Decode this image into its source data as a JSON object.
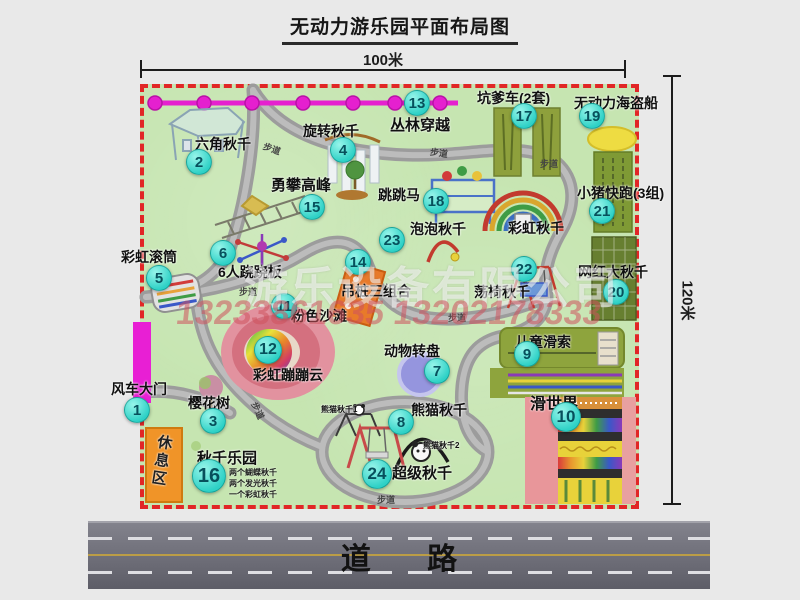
{
  "title": "无动力游乐园平面布局图",
  "dimensions": {
    "top": "100米",
    "right": "120米"
  },
  "watermark": {
    "company": "游乐设备有限公司",
    "phone": "13233861635 13202178333"
  },
  "road": {
    "label": "道 路"
  },
  "map": {
    "trail_label": "步道",
    "trail_labels": [
      [
        263,
        142,
        20
      ],
      [
        430,
        146,
        8
      ],
      [
        540,
        157,
        0
      ],
      [
        239,
        285,
        0
      ],
      [
        448,
        311,
        0
      ],
      [
        249,
        404,
        65
      ],
      [
        377,
        493,
        0
      ]
    ],
    "items": [
      {
        "num": 1,
        "label": "风车大门",
        "label_pos": [
          111,
          382
        ],
        "marker": [
          137,
          410
        ]
      },
      {
        "num": 2,
        "label": "六角秋千",
        "label_pos": [
          195,
          137
        ],
        "marker": [
          199,
          162
        ]
      },
      {
        "num": 3,
        "label": "樱花树",
        "label_pos": [
          188,
          396
        ],
        "marker": [
          213,
          421
        ]
      },
      {
        "num": 4,
        "label": "旋转秋千",
        "label_pos": [
          303,
          124
        ],
        "marker": [
          343,
          150
        ]
      },
      {
        "num": 5,
        "label": "彩虹滚筒",
        "label_pos": [
          121,
          250
        ],
        "marker": [
          159,
          278
        ]
      },
      {
        "num": 6,
        "label": "6人跷跷板",
        "label_pos": [
          218,
          265
        ],
        "marker": [
          223,
          253
        ]
      },
      {
        "num": 7,
        "label": "动物转盘",
        "label_pos": [
          384,
          344
        ],
        "marker": [
          437,
          371
        ]
      },
      {
        "num": 8,
        "label": "熊猫秋千",
        "label_pos": [
          411,
          403
        ],
        "marker": [
          401,
          422
        ]
      },
      {
        "num": 9,
        "label": "儿童滑索",
        "label_pos": [
          515,
          335
        ],
        "marker": [
          527,
          354
        ]
      },
      {
        "num": 10,
        "label": "滑世界",
        "label_pos": [
          530,
          396
        ],
        "marker": [
          566,
          417
        ],
        "label_size": 16,
        "marker_size": 30
      },
      {
        "num": 11,
        "label": "粉色沙滩",
        "label_pos": [
          291,
          309
        ],
        "marker": [
          284,
          306
        ]
      },
      {
        "num": 12,
        "label": "彩虹蹦蹦云",
        "label_pos": [
          253,
          368
        ],
        "marker": [
          268,
          350
        ],
        "marker_size": 28
      },
      {
        "num": 13,
        "label": "丛林穿越",
        "label_pos": [
          390,
          118
        ],
        "marker": [
          417,
          103
        ],
        "label_size": 15
      },
      {
        "num": 14,
        "label": "吊桩三组合",
        "label_pos": [
          341,
          284
        ],
        "marker": [
          358,
          262
        ]
      },
      {
        "num": 15,
        "label": "勇攀高峰",
        "label_pos": [
          271,
          178
        ],
        "marker": [
          312,
          207
        ],
        "label_size": 15
      },
      {
        "num": 16,
        "label": "秋千乐园",
        "label_pos": [
          197,
          451
        ],
        "marker": [
          209,
          476
        ],
        "label_size": 15,
        "marker_size": 34,
        "sub_labels": [
          "两个蝴蝶秋千",
          "两个发光秋千",
          "一个彩虹秋千"
        ],
        "sub_pos": [
          229,
          468
        ]
      },
      {
        "num": 17,
        "label": "坑爹车(2套)",
        "label_pos": [
          477,
          91
        ],
        "marker": [
          524,
          116
        ]
      },
      {
        "num": 18,
        "label": "跳跳马",
        "label_pos": [
          378,
          188
        ],
        "marker": [
          436,
          201
        ]
      },
      {
        "num": 19,
        "label": "无动力海盗船",
        "label_pos": [
          574,
          96
        ],
        "marker": [
          592,
          116
        ]
      },
      {
        "num": 20,
        "label": "网红大秋千",
        "label_pos": [
          578,
          265
        ],
        "marker": [
          616,
          292
        ]
      },
      {
        "num": 21,
        "label": "小猪快跑(3组)",
        "label_pos": [
          577,
          186
        ],
        "marker": [
          602,
          211
        ]
      },
      {
        "num": 22,
        "label": "荡椅秋千",
        "label_pos": [
          474,
          285
        ],
        "marker": [
          524,
          269
        ]
      },
      {
        "num": 23,
        "label": "泡泡秋千",
        "label_pos": [
          410,
          222
        ],
        "marker": [
          392,
          240
        ]
      },
      {
        "num": 24,
        "label": "超级秋千",
        "label_pos": [
          392,
          466
        ],
        "marker": [
          377,
          474
        ],
        "label_size": 15,
        "marker_size": 30
      }
    ],
    "extra_labels": [
      {
        "name": "rainbow-swing-label",
        "text": "彩虹秋千",
        "x": 508,
        "y": 221,
        "size": 14
      },
      {
        "name": "panda-swing-1-label",
        "text": "熊猫秋千1",
        "x": 321,
        "y": 406,
        "size": 8
      },
      {
        "name": "panda-swing-2-label",
        "text": "熊猫秋千2",
        "x": 423,
        "y": 442,
        "size": 8
      },
      {
        "name": "rest-area-label",
        "text": "休息区",
        "x": 152,
        "y": 434,
        "size": 15,
        "vertical": true
      }
    ]
  }
}
